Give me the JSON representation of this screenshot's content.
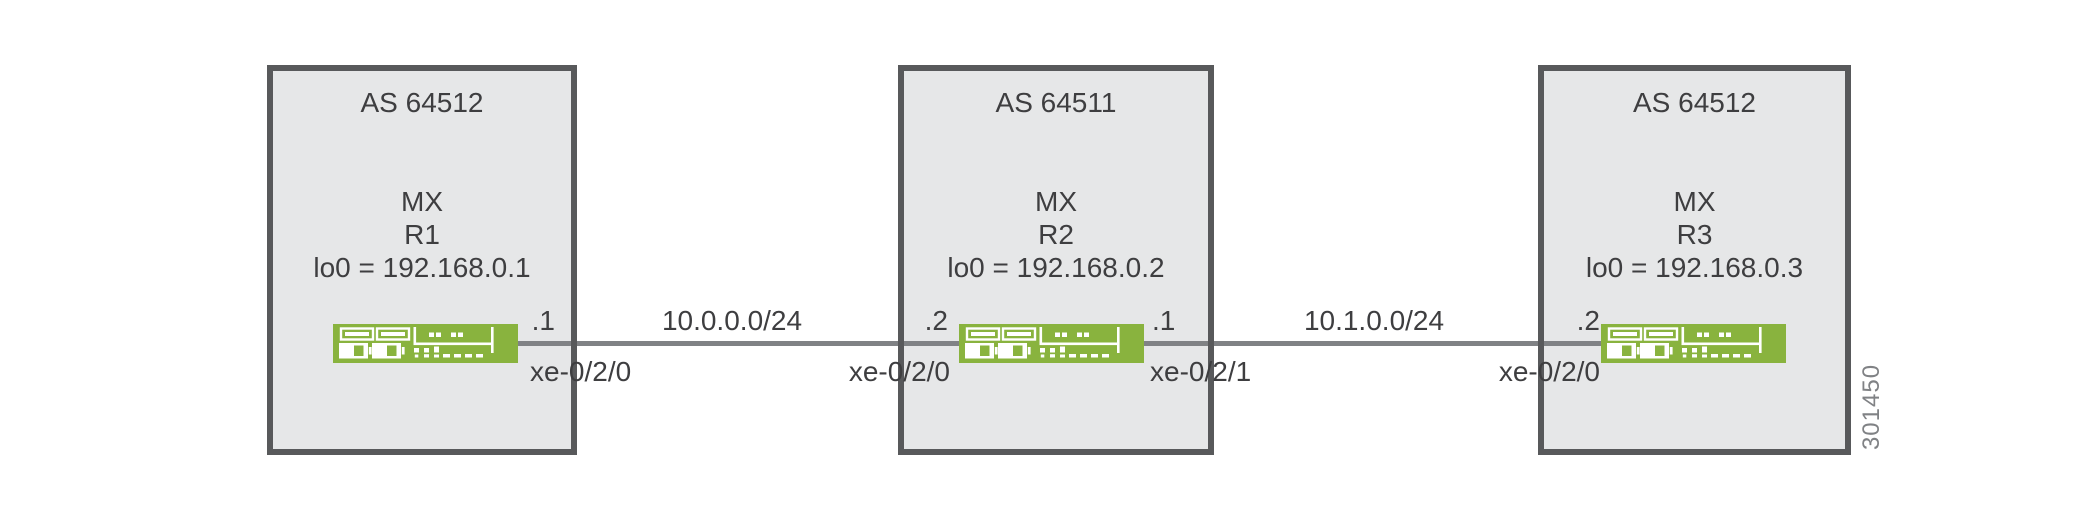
{
  "figure": {
    "number": "301450"
  },
  "colors": {
    "router_green": "#89b33e",
    "box_fill": "#e6e7e8",
    "box_border": "#58595b",
    "link_line": "#808285",
    "text": "#3e3e40"
  },
  "routers": [
    {
      "as_label": "AS 64512",
      "platform": "MX",
      "name": "R1",
      "loopback": "lo0 = 192.168.0.1",
      "icon": "mx-router-icon"
    },
    {
      "as_label": "AS 64511",
      "platform": "MX",
      "name": "R2",
      "loopback": "lo0 = 192.168.0.2",
      "icon": "mx-router-icon"
    },
    {
      "as_label": "AS 64512",
      "platform": "MX",
      "name": "R3",
      "loopback": "lo0 = 192.168.0.3",
      "icon": "mx-router-icon"
    }
  ],
  "links": [
    {
      "subnet": "10.0.0.0/24",
      "left": {
        "router": "R1",
        "address": ".1",
        "interface": "xe-0/2/0"
      },
      "right": {
        "router": "R2",
        "address": ".2",
        "interface": "xe-0/2/0"
      }
    },
    {
      "subnet": "10.1.0.0/24",
      "left": {
        "router": "R2",
        "address": ".1",
        "interface": "xe-0/2/1"
      },
      "right": {
        "router": "R3",
        "address": ".2",
        "interface": "xe-0/2/0"
      }
    }
  ]
}
